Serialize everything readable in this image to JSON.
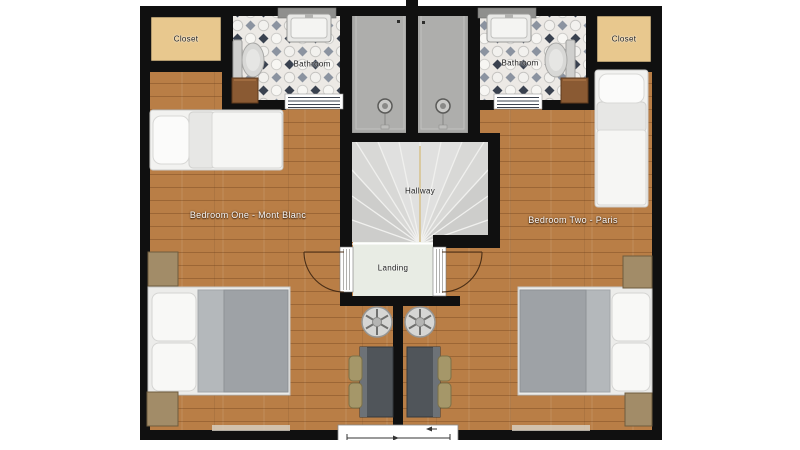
{
  "plan": {
    "rooms": {
      "closet_left": {
        "label": "Closet"
      },
      "closet_right": {
        "label": "Closet"
      },
      "bathroom_left": {
        "label": "Bathroom"
      },
      "bathroom_right": {
        "label": "Bathroom"
      },
      "bedroom_one": {
        "label": "Bedroom One - Mont Blanc"
      },
      "bedroom_two": {
        "label": "Bedroom Two - Paris"
      },
      "hallway": {
        "label": "Hallway"
      },
      "landing": {
        "label": "Landing"
      }
    },
    "colors": {
      "wall": "#101010",
      "wood_floor": "#b97e46",
      "tile_base": "#ece9e5",
      "tile_diamond_dark": "#39414f",
      "tile_diamond_gray": "#8b93a0",
      "closet_fill": "#e8c88e",
      "hallway_fill": "#d8d8d6",
      "landing_fill": "#e8ece4",
      "shower_fill": "#a9a9a7",
      "duvet_gray": "#9ea2a6",
      "desk_dark": "#50555a",
      "chair_tan": "#a59769",
      "cabinet_brown": "#8a5a33"
    }
  }
}
